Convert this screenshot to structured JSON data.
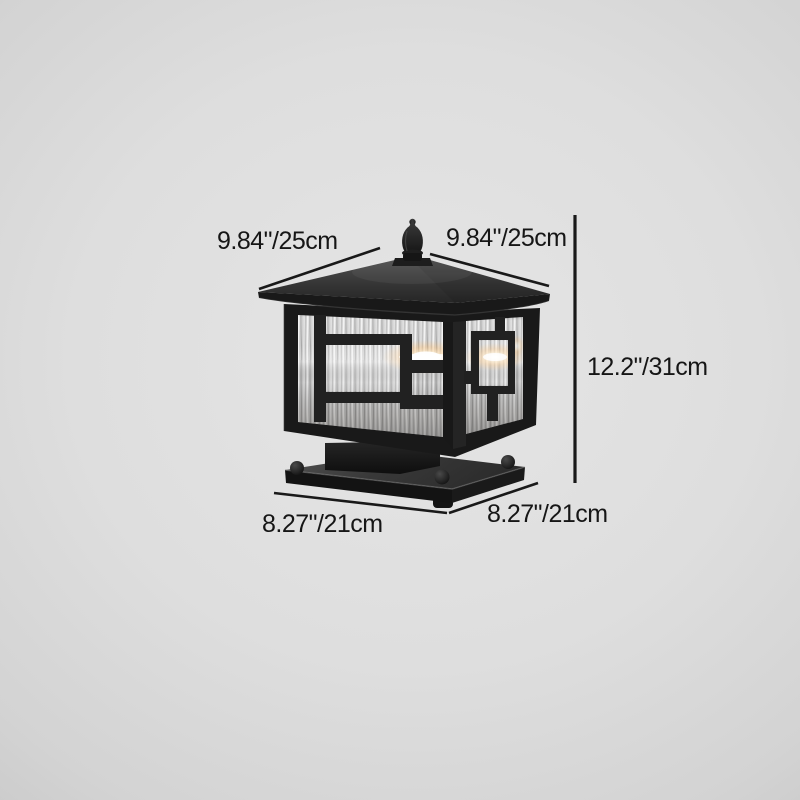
{
  "image": {
    "subject": "Black square outdoor pillar post lantern with rippled water-glass panels and Chinese fret ornament, lit from within, on a plain gray studio background with dimension annotations"
  },
  "annotations": {
    "top_left": "9.84\"/25cm",
    "top_right": "9.84\"/25cm",
    "height_right": "12.2\"/31cm",
    "bottom_left": "8.27\"/21cm",
    "bottom_right": "8.27\"/21cm"
  },
  "colors": {
    "background_center": "#e5e5e5",
    "background_edge": "#c2c2c2",
    "annotation_text": "#161616",
    "annotation_line": "#191919",
    "lamp_frame": "#1b1b1b",
    "roof_highlight": "#4a4a4a",
    "glass_base": "#c9c9c9",
    "glow_warm": "#ffd98f",
    "glow_core": "#ffffff"
  }
}
